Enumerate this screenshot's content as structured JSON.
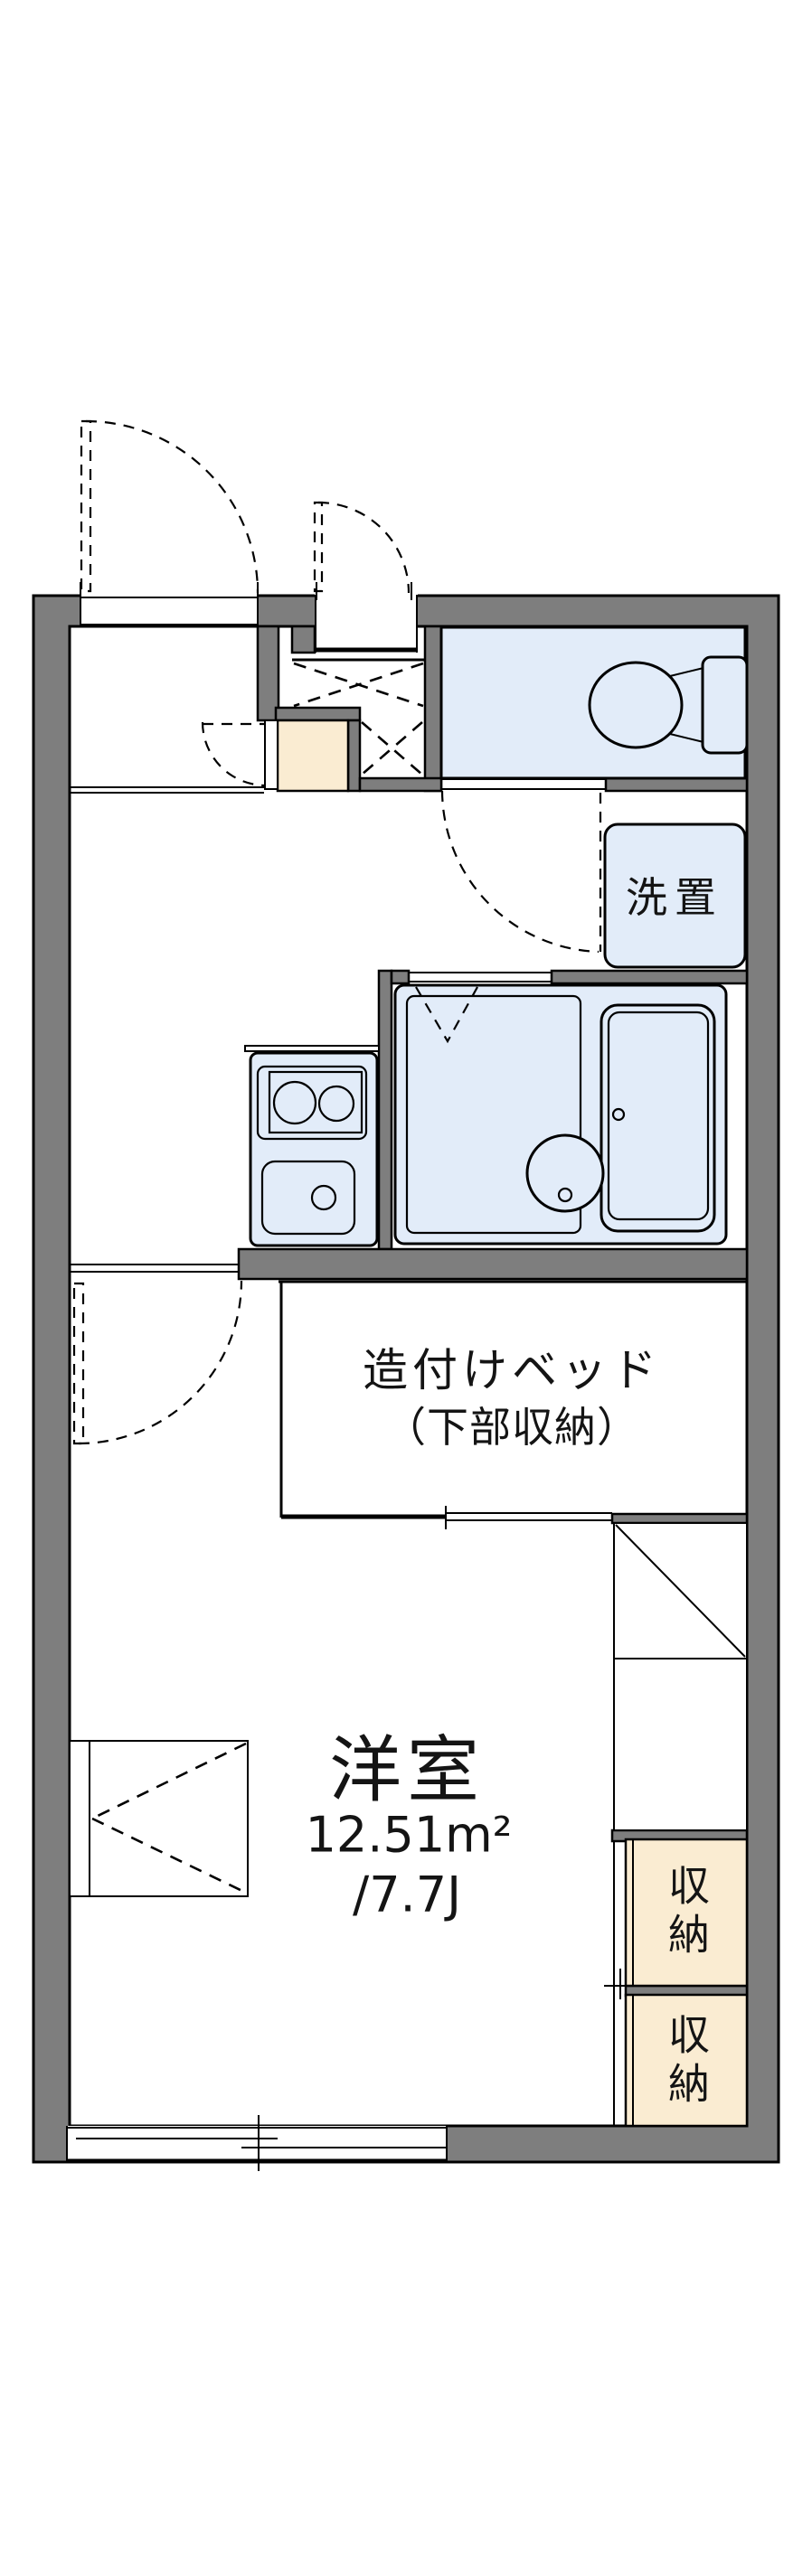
{
  "plan": {
    "colors": {
      "wall": "#7e7e7e",
      "fixture": "#e2ecf9",
      "storage": "#faecd2",
      "line": "#000000",
      "background": "#ffffff"
    },
    "labels": {
      "laundry": "洗置",
      "bed_line1": "造付けベッド",
      "bed_line2": "（下部収納）",
      "room_name": "洋室",
      "room_area": "12.51m²",
      "room_tatami": "/7.7J",
      "storage_upper": "収納",
      "storage_lower": "収納"
    }
  }
}
